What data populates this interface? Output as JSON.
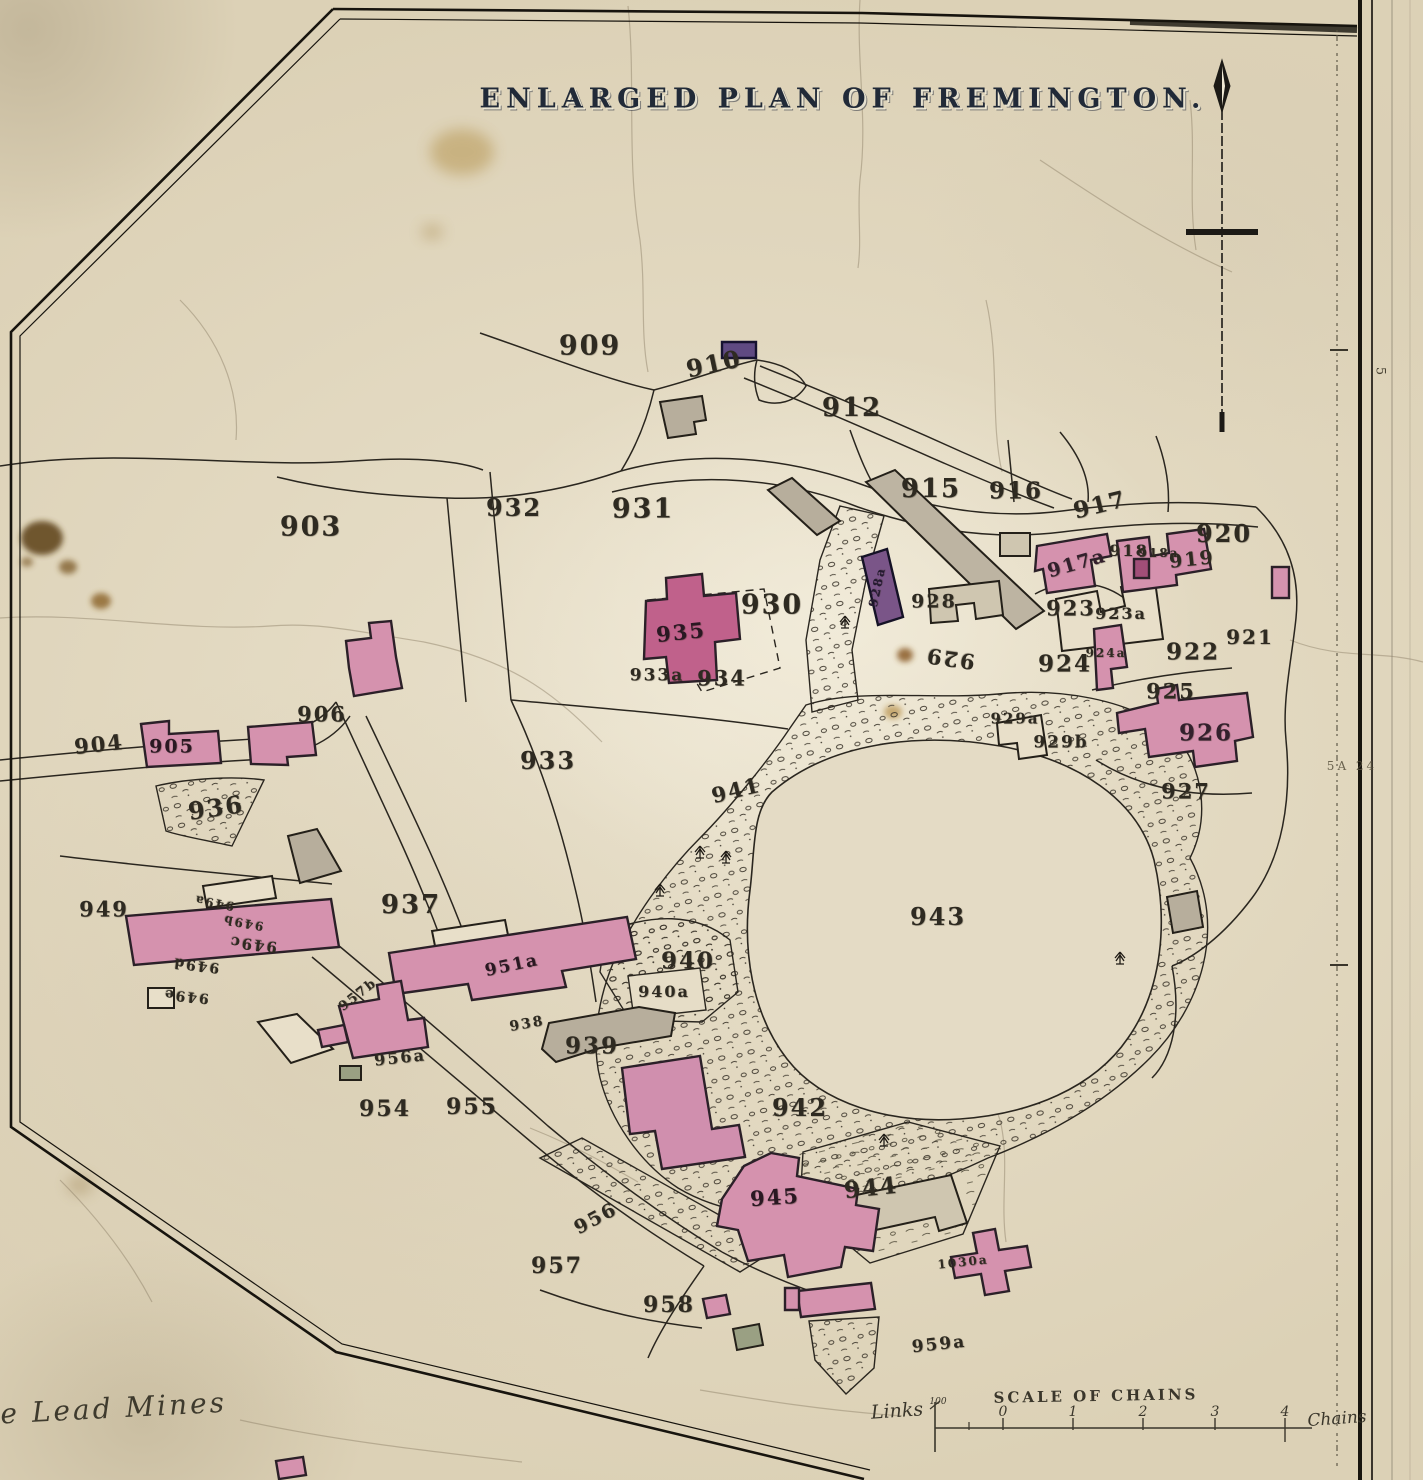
{
  "title": "ENLARGED PLAN OF FREMINGTON.",
  "corner_note": "te Lead Mines",
  "margin": {
    "edge_number": "5",
    "sheet_ref": "5A 24"
  },
  "scale_bar": {
    "title": "SCALE OF CHAINS",
    "left_label": "Links",
    "left_sub": "100",
    "right_label": "Chains",
    "ticks": [
      {
        "label": "0",
        "x": 1003
      },
      {
        "label": "1",
        "x": 1073
      },
      {
        "label": "2",
        "x": 1143
      },
      {
        "label": "3",
        "x": 1215
      },
      {
        "label": "4",
        "x": 1285
      }
    ]
  },
  "parcel_labels": [
    {
      "t": "909",
      "x": 590,
      "y": 346,
      "s": 27
    },
    {
      "t": "910",
      "x": 714,
      "y": 364,
      "s": 24,
      "r": -12
    },
    {
      "t": "912",
      "x": 852,
      "y": 408,
      "s": 26
    },
    {
      "t": "915",
      "x": 931,
      "y": 489,
      "s": 26
    },
    {
      "t": "916",
      "x": 1016,
      "y": 491,
      "s": 23
    },
    {
      "t": "917",
      "x": 1100,
      "y": 505,
      "s": 23,
      "r": -14
    },
    {
      "t": "917a",
      "x": 1077,
      "y": 564,
      "s": 19,
      "r": -16,
      "c": "#33202c"
    },
    {
      "t": "918",
      "x": 1129,
      "y": 551,
      "s": 16
    },
    {
      "t": "918a",
      "x": 1159,
      "y": 553,
      "s": 12
    },
    {
      "t": "919",
      "x": 1192,
      "y": 560,
      "s": 19,
      "r": -6
    },
    {
      "t": "920",
      "x": 1224,
      "y": 534,
      "s": 24
    },
    {
      "t": "921",
      "x": 1250,
      "y": 637,
      "s": 20
    },
    {
      "t": "922",
      "x": 1193,
      "y": 652,
      "s": 23
    },
    {
      "t": "923",
      "x": 1071,
      "y": 608,
      "s": 21
    },
    {
      "t": "923a",
      "x": 1121,
      "y": 614,
      "s": 16
    },
    {
      "t": "924",
      "x": 1065,
      "y": 664,
      "s": 23
    },
    {
      "t": "924a",
      "x": 1106,
      "y": 653,
      "s": 12
    },
    {
      "t": "925",
      "x": 1171,
      "y": 691,
      "s": 21
    },
    {
      "t": "926",
      "x": 1206,
      "y": 733,
      "s": 23,
      "c": "#33202c"
    },
    {
      "t": "927",
      "x": 1186,
      "y": 791,
      "s": 21
    },
    {
      "t": "928",
      "x": 934,
      "y": 602,
      "s": 19
    },
    {
      "t": "928a",
      "x": 877,
      "y": 587,
      "s": 12,
      "r": -78,
      "c": "#241a30"
    },
    {
      "t": "929",
      "x": 950,
      "y": 659,
      "s": 21,
      "r": 188
    },
    {
      "t": "929a",
      "x": 1015,
      "y": 719,
      "s": 15
    },
    {
      "t": "929b",
      "x": 1061,
      "y": 743,
      "s": 17
    },
    {
      "t": "930",
      "x": 772,
      "y": 605,
      "s": 27
    },
    {
      "t": "931",
      "x": 643,
      "y": 509,
      "s": 27
    },
    {
      "t": "932",
      "x": 514,
      "y": 508,
      "s": 24
    },
    {
      "t": "933",
      "x": 548,
      "y": 761,
      "s": 24
    },
    {
      "t": "933a",
      "x": 657,
      "y": 676,
      "s": 17
    },
    {
      "t": "934",
      "x": 722,
      "y": 678,
      "s": 21
    },
    {
      "t": "935",
      "x": 681,
      "y": 632,
      "s": 21,
      "r": -6,
      "c": "#2a1822"
    },
    {
      "t": "936",
      "x": 216,
      "y": 808,
      "s": 24,
      "r": -8
    },
    {
      "t": "937",
      "x": 411,
      "y": 905,
      "s": 26
    },
    {
      "t": "938",
      "x": 527,
      "y": 1024,
      "s": 14,
      "r": -10
    },
    {
      "t": "939",
      "x": 592,
      "y": 1046,
      "s": 23
    },
    {
      "t": "940",
      "x": 688,
      "y": 961,
      "s": 23
    },
    {
      "t": "940a",
      "x": 664,
      "y": 992,
      "s": 16
    },
    {
      "t": "941",
      "x": 736,
      "y": 790,
      "s": 21,
      "r": -14
    },
    {
      "t": "942",
      "x": 800,
      "y": 1108,
      "s": 24
    },
    {
      "t": "943",
      "x": 938,
      "y": 917,
      "s": 24
    },
    {
      "t": "944",
      "x": 871,
      "y": 1188,
      "s": 23,
      "r": -6
    },
    {
      "t": "945",
      "x": 775,
      "y": 1197,
      "s": 21,
      "r": -4,
      "c": "#2a1822"
    },
    {
      "t": "949",
      "x": 104,
      "y": 909,
      "s": 21
    },
    {
      "t": "949a",
      "x": 214,
      "y": 903,
      "s": 12,
      "r": 190
    },
    {
      "t": "949b",
      "x": 243,
      "y": 923,
      "s": 12,
      "r": 190
    },
    {
      "t": "949c",
      "x": 253,
      "y": 944,
      "s": 15,
      "r": 187
    },
    {
      "t": "949d",
      "x": 196,
      "y": 965,
      "s": 14,
      "r": 187
    },
    {
      "t": "949e",
      "x": 186,
      "y": 996,
      "s": 14,
      "r": 186
    },
    {
      "t": "951a",
      "x": 512,
      "y": 966,
      "s": 17,
      "r": -12,
      "c": "#2a1822"
    },
    {
      "t": "957b",
      "x": 358,
      "y": 995,
      "s": 13,
      "r": -38
    },
    {
      "t": "956a",
      "x": 400,
      "y": 1058,
      "s": 16,
      "r": -6
    },
    {
      "t": "954",
      "x": 385,
      "y": 1109,
      "s": 22
    },
    {
      "t": "955",
      "x": 472,
      "y": 1107,
      "s": 22
    },
    {
      "t": "956",
      "x": 596,
      "y": 1219,
      "s": 19,
      "r": -28
    },
    {
      "t": "957",
      "x": 557,
      "y": 1266,
      "s": 22
    },
    {
      "t": "958",
      "x": 669,
      "y": 1305,
      "s": 22
    },
    {
      "t": "959a",
      "x": 939,
      "y": 1345,
      "s": 17,
      "r": -6
    },
    {
      "t": "903",
      "x": 311,
      "y": 527,
      "s": 27
    },
    {
      "t": "904",
      "x": 99,
      "y": 744,
      "s": 21,
      "r": -6
    },
    {
      "t": "905",
      "x": 172,
      "y": 747,
      "s": 19,
      "c": "#2a1822"
    },
    {
      "t": "906",
      "x": 322,
      "y": 714,
      "s": 21
    },
    {
      "t": "1030a",
      "x": 963,
      "y": 1262,
      "s": 12,
      "r": -6
    }
  ]
}
